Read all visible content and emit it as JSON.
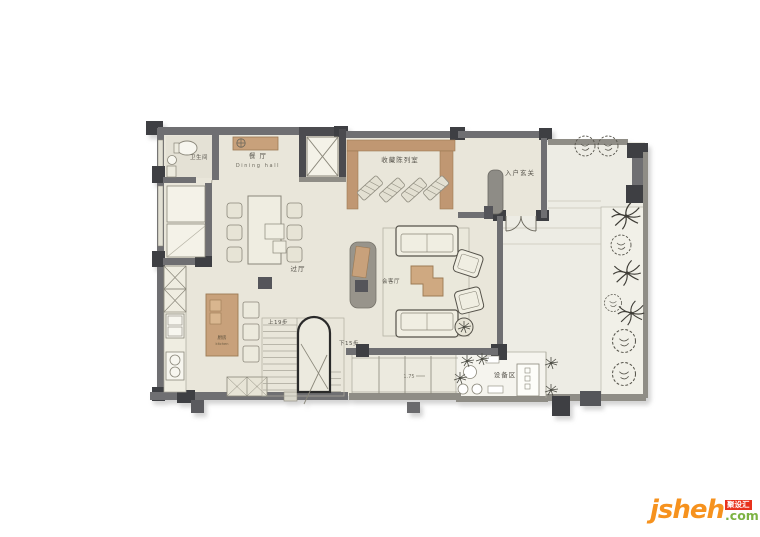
{
  "rooms": {
    "bathroom": "卫生间",
    "dining_cn": "餐 厅",
    "dining_en": "Dining hall",
    "collection": "收藏陈列室",
    "foyer": "入户玄关",
    "hallway": "过厅",
    "living": "会客厅",
    "kitchen_cn": "厨房",
    "kitchen_en": "kitchen",
    "equipment": "设备区"
  },
  "stairs": {
    "up": "上19步",
    "down": "下15步"
  },
  "dims": {
    "bay_depth": "1.75"
  },
  "watermark": {
    "brand": "jsheh",
    "tld": ".com",
    "badge": "聚设汇"
  },
  "colors": {
    "floor_indoor": "#e9e6da",
    "floor_terrace": "#edece4",
    "floor_bed": "#f1f0e8",
    "wall_gray": "#6f6f72",
    "wall_light": "#8f8d86",
    "column_dark": "#3e3f43",
    "wood_tan": "#c8a17b",
    "furniture_fill": "#f0eee2",
    "furniture_outline": "#8a877a",
    "brand_orange": "#f6921e",
    "brand_green": "#7cb342",
    "badge_red": "#e8311c"
  }
}
